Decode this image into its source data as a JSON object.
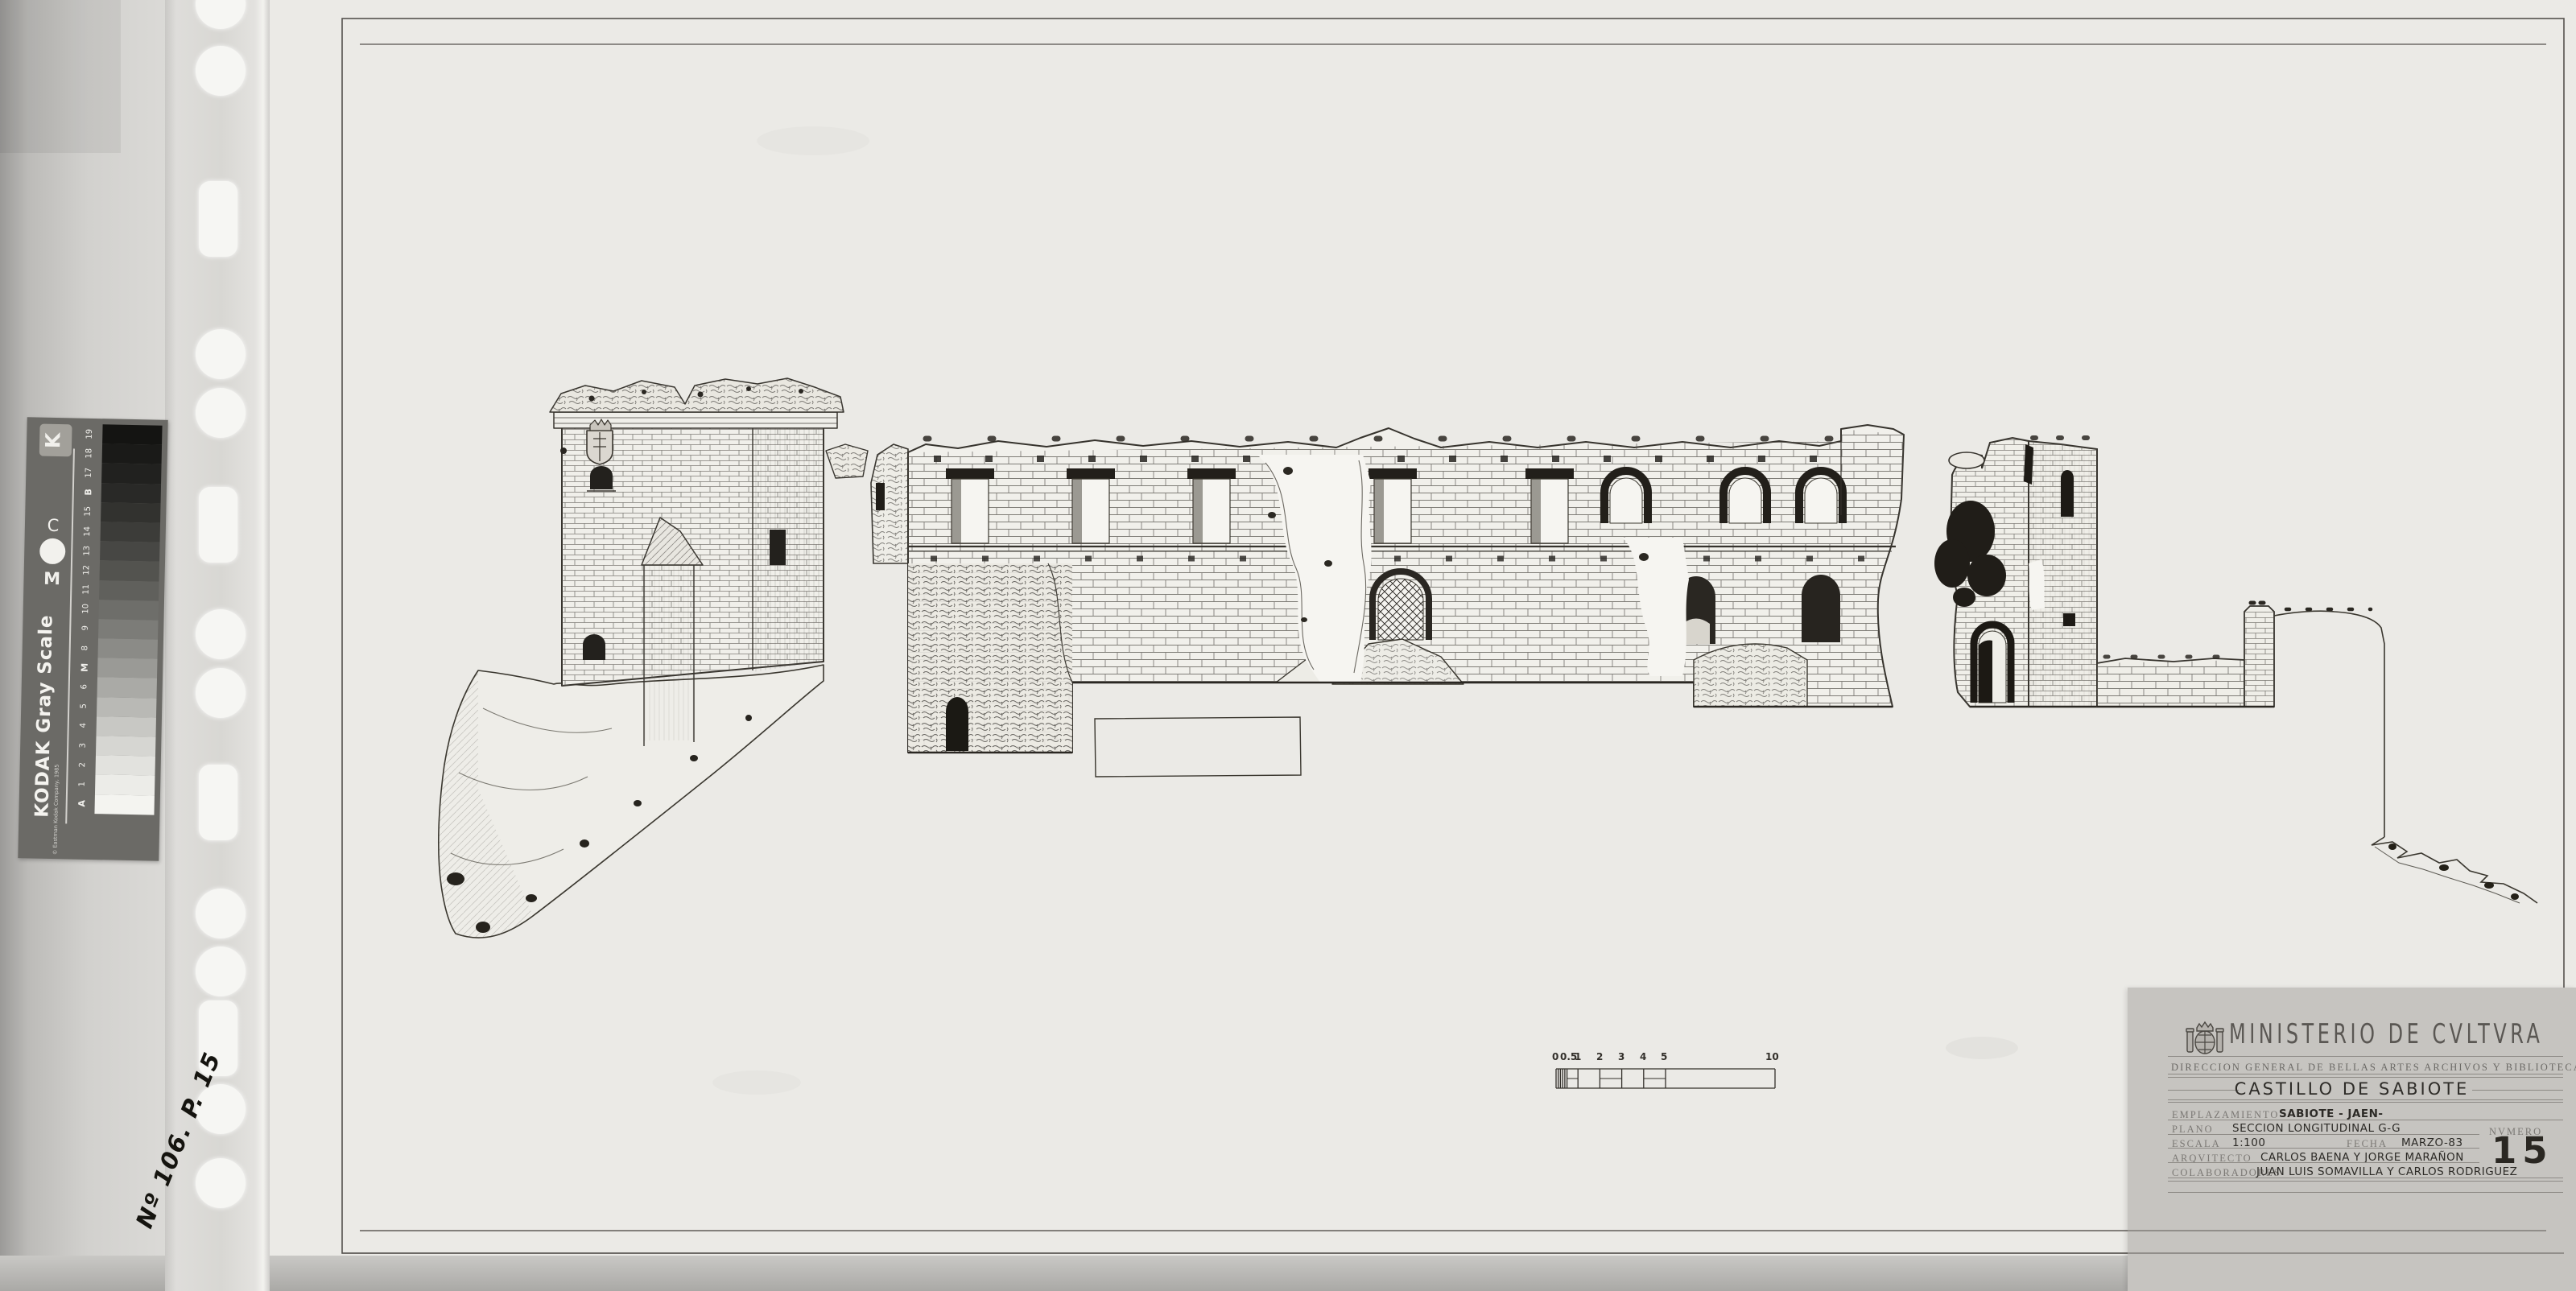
{
  "sleeve": {
    "note": "Nº 106. P. 15"
  },
  "gray_scale_card": {
    "title": "KODAK Gray Scale",
    "copyright": "© Eastman Kodak Company, 1985",
    "logo_letter": "K",
    "registration_top": "C",
    "registration_bottom": "M",
    "steps": [
      "19",
      "18",
      "17",
      "B",
      "15",
      "14",
      "13",
      "12",
      "11",
      "10",
      "9",
      "8",
      "M",
      "6",
      "5",
      "4",
      "3",
      "2",
      "1",
      "A"
    ]
  },
  "title_block": {
    "ministry": "MINISTERIO DE CVLTVRA",
    "department": "DIRECCION GENERAL DE BELLAS ARTES ARCHIVOS Y BIBLIOTECAS",
    "project_title": "CASTILLO DE SABIOTE",
    "emplazamiento_label": "EMPLAZAMIENTO",
    "emplazamiento": "SABIOTE - JAEN-",
    "plano_label": "PLANO",
    "plano": "SECCION LONGITUDINAL G-G",
    "escala_label": "ESCALA",
    "escala": "1:100",
    "fecha_label": "FECHA",
    "fecha": "MARZO-83",
    "arquitecto_label": "ARQVITECTO",
    "arquitecto": "CARLOS BAENA Y JORGE MARAÑON",
    "colaboradores_label": "COLABORADORES",
    "colaboradores": "JUAN LUIS SOMAVILLA Y CARLOS RODRIGUEZ",
    "numero_label": "NVMERO",
    "numero": "15"
  },
  "scale_bar": {
    "unit_labels": [
      "0",
      "0.5",
      "1",
      "2",
      "3",
      "4",
      "5",
      "10"
    ]
  },
  "colors": {
    "paper": "#ebeae6",
    "background": "#dddcd8",
    "title_card": "#c6c4c0",
    "ink": "#2f2d2a"
  }
}
